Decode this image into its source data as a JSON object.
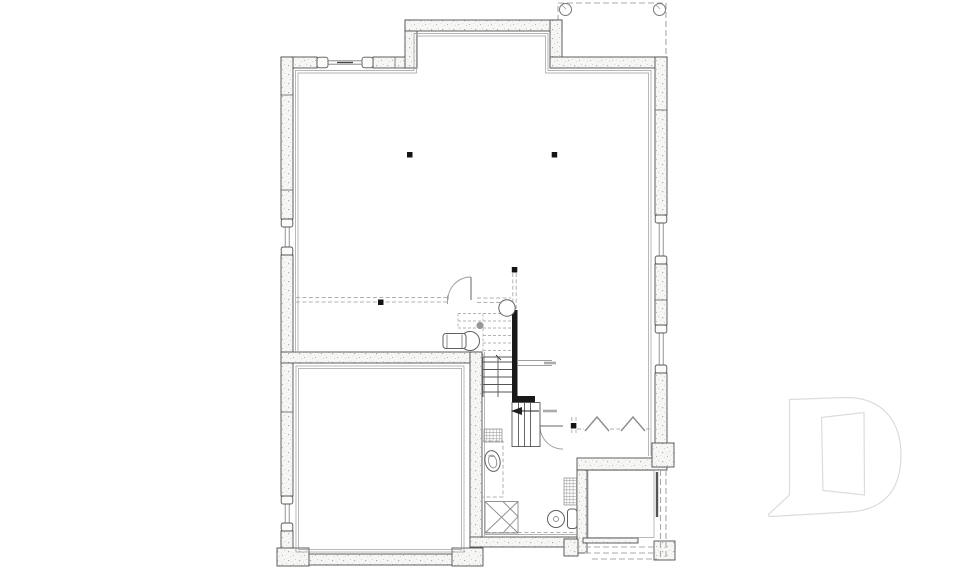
{
  "drawing": {
    "kind": "basement foundation floor plan",
    "visible_text": [],
    "colors": {
      "background": "#ffffff",
      "wall_outline": "#4f4f4f",
      "wall_fill": "#f6f6f4",
      "inner_line": "#9a9a9a",
      "dashed_line": "#b0b0b0",
      "stair_wall_black": "#191919",
      "fixture_line": "#606060",
      "logo_outline": "#dcdcdc"
    },
    "elements": {
      "deck": "dashed deck outline above with two round corner posts",
      "bumpout": "rectangular wall bump-out at top center",
      "windows": "six foundation window openings in concrete walls",
      "stair": "l-shaped staircase with solid lower treads, dashed upper treads and direction arrow",
      "toilet": "toilet rough-in beside stair",
      "floor_drain": "small round floor drain",
      "column": "round structural column at stair head",
      "vanity": "dashed future vanity outline with oval sink rough-in",
      "sump": "square sump pit with x bracing",
      "hvac_chase": "hatched mechanical chase",
      "laundry": "washer drum and standpipe rough-in",
      "hatch_patch": "hatched landing patch under stair",
      "posts": "five square steel support posts",
      "beam_symbols": "two chevron beam/brace symbols near rear door",
      "doors": "two interior swing doors shown with quarter-circle arcs",
      "stoop": "rear concrete stoop with dashed stair treads above",
      "logo": "light gray letter-D builder watermark"
    }
  }
}
